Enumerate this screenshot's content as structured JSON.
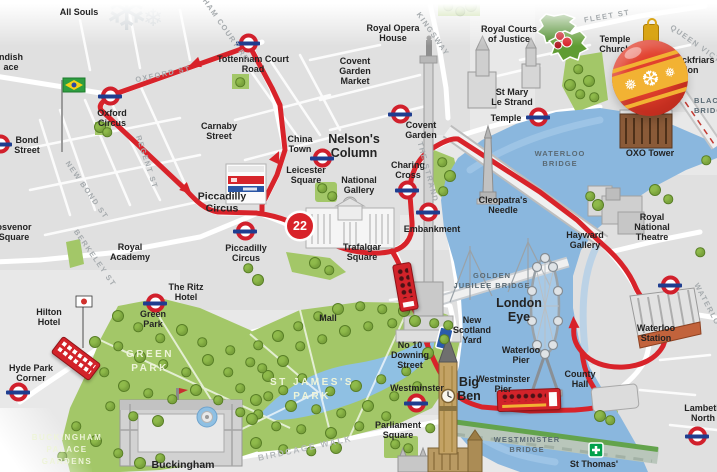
{
  "map": {
    "title": "London sightseeing bus tour map",
    "route_badge": "22",
    "colors": {
      "route_red": "#d8232a",
      "river_blue": "#8ab7de",
      "park_green": "#a3c768",
      "roundel_red": "#d1202c",
      "roundel_blue": "#1f3d8f",
      "bauble_red": "#e2402e",
      "bauble_gold": "#f2b233"
    },
    "decor": {
      "snowflake": "❄",
      "bauble_snowflakes": [
        "❅",
        "❆",
        "❅"
      ]
    },
    "labels": [
      {
        "id": "all-souls",
        "t": "All Souls",
        "x": 79,
        "y": 12,
        "cls": "lbl"
      },
      {
        "id": "cavendish-partial",
        "t": "ndish\nace",
        "x": 11,
        "y": 62,
        "cls": "lbl"
      },
      {
        "id": "bond-street",
        "t": "Bond\nStreet",
        "x": 27,
        "y": 145,
        "cls": "lbl"
      },
      {
        "id": "oxford-circus",
        "t": "Oxford\nCircus",
        "x": 112,
        "y": 118,
        "cls": "lbl"
      },
      {
        "id": "carnaby-street",
        "t": "Carnaby\nStreet",
        "x": 219,
        "y": 131,
        "cls": "lbl"
      },
      {
        "id": "tottenham-court-road",
        "t": "Tottenham Court\nRoad",
        "x": 253,
        "y": 64,
        "cls": "lbl"
      },
      {
        "id": "china-town",
        "t": "China\nTown",
        "x": 300,
        "y": 144,
        "cls": "lbl"
      },
      {
        "id": "leicester-square",
        "t": "Leicester\nSquare",
        "x": 306,
        "y": 175,
        "cls": "lbl"
      },
      {
        "id": "covent-garden-market",
        "t": "Covent\nGarden\nMarket",
        "x": 355,
        "y": 71,
        "cls": "lbl"
      },
      {
        "id": "royal-opera-house",
        "t": "Royal Opera\nHouse",
        "x": 393,
        "y": 33,
        "cls": "lbl"
      },
      {
        "id": "covent-garden",
        "t": "Covent\nGarden",
        "x": 421,
        "y": 130,
        "cls": "lbl"
      },
      {
        "id": "royal-courts",
        "t": "Royal Courts\nof Justice",
        "x": 509,
        "y": 34,
        "cls": "lbl"
      },
      {
        "id": "temple-church",
        "t": "Temple\nChurch",
        "x": 615,
        "y": 44,
        "cls": "lbl"
      },
      {
        "id": "st-mary-le-strand",
        "t": "St Mary\nLe Strand",
        "x": 512,
        "y": 97,
        "cls": "lbl"
      },
      {
        "id": "temple",
        "t": "Temple",
        "x": 506,
        "y": 118,
        "cls": "lbl"
      },
      {
        "id": "blackfriars-station",
        "t": "Blackfriars\nStation",
        "x": 668,
        "y": 55,
        "cls": "lbl noc"
      },
      {
        "id": "oxo-tower",
        "t": "OXO Tower",
        "x": 650,
        "y": 153,
        "cls": "lbl"
      },
      {
        "id": "nelsons-column",
        "t": "Nelson's\nColumn",
        "x": 354,
        "y": 146,
        "cls": "lbl big"
      },
      {
        "id": "national-gallery",
        "t": "National\nGallery",
        "x": 359,
        "y": 185,
        "cls": "lbl"
      },
      {
        "id": "charing-cross",
        "t": "Charing\nCross",
        "x": 408,
        "y": 170,
        "cls": "lbl"
      },
      {
        "id": "embankment",
        "t": "Embankment",
        "x": 432,
        "y": 229,
        "cls": "lbl"
      },
      {
        "id": "cleopatras-needle",
        "t": "Cleopatra's\nNeedle",
        "x": 503,
        "y": 205,
        "cls": "lbl"
      },
      {
        "id": "royal-national-theatre",
        "t": "Royal\nNational\nTheatre",
        "x": 652,
        "y": 227,
        "cls": "lbl"
      },
      {
        "id": "hayward-gallery",
        "t": "Hayward\nGallery",
        "x": 585,
        "y": 240,
        "cls": "lbl"
      },
      {
        "id": "waterloo-station",
        "t": "Waterloo\nStation",
        "x": 656,
        "y": 333,
        "cls": "lbl"
      },
      {
        "id": "county-hall",
        "t": "County\nHall",
        "x": 580,
        "y": 379,
        "cls": "lbl"
      },
      {
        "id": "waterloo-pier",
        "t": "Waterloo\nPier",
        "x": 521,
        "y": 355,
        "cls": "lbl"
      },
      {
        "id": "westminster-pier",
        "t": "Westminster\nPier",
        "x": 503,
        "y": 384,
        "cls": "lbl"
      },
      {
        "id": "london-eye",
        "t": "London\nEye",
        "x": 519,
        "y": 310,
        "cls": "lbl big"
      },
      {
        "id": "new-scotland-yard",
        "t": "New\nScotland\nYard",
        "x": 472,
        "y": 330,
        "cls": "lbl"
      },
      {
        "id": "no10-downing",
        "t": "No 10\nDowning\nStreet",
        "x": 410,
        "y": 355,
        "cls": "lbl"
      },
      {
        "id": "westminster",
        "t": "Westminster",
        "x": 417,
        "y": 388,
        "cls": "lbl"
      },
      {
        "id": "big-ben",
        "t": "Big\nBen",
        "x": 469,
        "y": 389,
        "cls": "lbl big"
      },
      {
        "id": "parliament-square",
        "t": "Parliament\nSquare",
        "x": 398,
        "y": 430,
        "cls": "lbl"
      },
      {
        "id": "st-thomas",
        "t": "St Thomas'",
        "x": 594,
        "y": 464,
        "cls": "lbl"
      },
      {
        "id": "lambeth-north",
        "t": "Lambeth\nNorth",
        "x": 703,
        "y": 413,
        "cls": "lbl"
      },
      {
        "id": "mall",
        "t": "Mall",
        "x": 328,
        "y": 318,
        "cls": "lbl"
      },
      {
        "id": "hilton-hotel",
        "t": "Hilton\nHotel",
        "x": 49,
        "y": 317,
        "cls": "lbl"
      },
      {
        "id": "ritz-hotel",
        "t": "The Ritz\nHotel",
        "x": 186,
        "y": 292,
        "cls": "lbl"
      },
      {
        "id": "royal-academy",
        "t": "Royal\nAcademy",
        "x": 130,
        "y": 252,
        "cls": "lbl"
      },
      {
        "id": "grosvenor-partial",
        "t": "osvenor\nSquare",
        "x": 14,
        "y": 232,
        "cls": "lbl"
      },
      {
        "id": "hyde-park-corner",
        "t": "Hyde Park\nCorner",
        "x": 31,
        "y": 373,
        "cls": "lbl"
      },
      {
        "id": "green-park-station",
        "t": "Green\nPark",
        "x": 153,
        "y": 319,
        "cls": "lbl"
      },
      {
        "id": "piccadilly-circus-main",
        "t": "Piccadilly\nCircus",
        "x": 222,
        "y": 203,
        "cls": "lbl med"
      },
      {
        "id": "piccadilly-circus-tube",
        "t": "Piccadilly\nCircus",
        "x": 246,
        "y": 253,
        "cls": "lbl"
      },
      {
        "id": "trafalgar-square",
        "t": "Trafalgar\nSquare",
        "x": 362,
        "y": 252,
        "cls": "lbl"
      },
      {
        "id": "buckingham",
        "t": "Buckingham",
        "x": 183,
        "y": 466,
        "cls": "lbl med"
      },
      {
        "id": "oxford-st",
        "t": "OXFORD ST",
        "x": 163,
        "y": 74,
        "cls": "street",
        "rot": -12
      },
      {
        "id": "regent-st",
        "t": "REGENT ST",
        "x": 147,
        "y": 162,
        "cls": "street",
        "rot": 72
      },
      {
        "id": "new-bond-st",
        "t": "NEW BOND ST",
        "x": 87,
        "y": 190,
        "cls": "street",
        "rot": 55
      },
      {
        "id": "berkeley-st",
        "t": "BERKELEY ST",
        "x": 95,
        "y": 258,
        "cls": "street",
        "rot": 55
      },
      {
        "id": "tottenham-ct-rd-street",
        "t": "TTENHAM COURT RD",
        "x": 219,
        "y": 20,
        "cls": "street",
        "rot": 55
      },
      {
        "id": "kingsway",
        "t": "KINGSWAY",
        "x": 433,
        "y": 34,
        "cls": "street",
        "rot": 55
      },
      {
        "id": "the-strand",
        "t": "THE STRAND",
        "x": 428,
        "y": 172,
        "cls": "street",
        "rot": 75
      },
      {
        "id": "fleet-st",
        "t": "FLEET ST",
        "x": 607,
        "y": 16,
        "cls": "street",
        "rot": -10
      },
      {
        "id": "queen-victoria-st",
        "t": "QUEEN VICTORIA ST",
        "x": 712,
        "y": 55,
        "cls": "street",
        "rot": 35
      },
      {
        "id": "waterloo-rd",
        "t": "WATERLOO RD",
        "x": 713,
        "y": 315,
        "cls": "street",
        "rot": 62
      },
      {
        "id": "birdcage-walk",
        "t": "BIRDCAGE WALK",
        "x": 305,
        "y": 448,
        "cls": "roadlbl",
        "rot": -12
      },
      {
        "id": "waterloo-bridge",
        "t": "WATERLOO\nBRIDGE",
        "x": 560,
        "y": 159,
        "cls": "bridge"
      },
      {
        "id": "golden-jubilee-bridge",
        "t": "GOLDEN\nJUBILEE BRIDGE",
        "x": 492,
        "y": 281,
        "cls": "bridge"
      },
      {
        "id": "westminster-bridge",
        "t": "WESTMINSTER\nBRIDGE",
        "x": 527,
        "y": 445,
        "cls": "bridge"
      },
      {
        "id": "blackfriars-bridge",
        "t": "BLACKFRIARS\nBRIDGE",
        "x": 694,
        "y": 96,
        "cls": "bridge noc"
      },
      {
        "id": "green-park",
        "t": "GREEN\nPARK",
        "x": 150,
        "y": 362,
        "cls": "park"
      },
      {
        "id": "st-jamess-park",
        "t": "ST JAMES'S\nPARK",
        "x": 312,
        "y": 390,
        "cls": "park"
      },
      {
        "id": "buckingham-palace-gardens",
        "t": "BUCKINGHAM\nPALACE\nGARDENS",
        "x": 67,
        "y": 450,
        "cls": "park parksm"
      }
    ],
    "stations": [
      {
        "id": "oxford-circus",
        "x": 110,
        "y": 96
      },
      {
        "id": "bond-street",
        "x": 0,
        "y": 144
      },
      {
        "id": "tottenham-court-road",
        "x": 248,
        "y": 43
      },
      {
        "id": "leicester-square",
        "x": 322,
        "y": 158
      },
      {
        "id": "covent-garden",
        "x": 400,
        "y": 114
      },
      {
        "id": "piccadilly-circus",
        "x": 245,
        "y": 231
      },
      {
        "id": "charing-cross",
        "x": 407,
        "y": 190
      },
      {
        "id": "embankment",
        "x": 428,
        "y": 212
      },
      {
        "id": "temple",
        "x": 538,
        "y": 117
      },
      {
        "id": "green-park",
        "x": 155,
        "y": 303
      },
      {
        "id": "hyde-park-corner",
        "x": 18,
        "y": 392
      },
      {
        "id": "westminster",
        "x": 416,
        "y": 403
      },
      {
        "id": "waterloo",
        "x": 670,
        "y": 285
      },
      {
        "id": "lambeth-north",
        "x": 697,
        "y": 436
      }
    ],
    "trees": [
      [
        118,
        316
      ],
      [
        138,
        327
      ],
      [
        160,
        338
      ],
      [
        182,
        330
      ],
      [
        202,
        342
      ],
      [
        118,
        346
      ],
      [
        140,
        357
      ],
      [
        163,
        364
      ],
      [
        186,
        372
      ],
      [
        208,
        360
      ],
      [
        228,
        372
      ],
      [
        104,
        372
      ],
      [
        124,
        386
      ],
      [
        148,
        393
      ],
      [
        172,
        399
      ],
      [
        196,
        390
      ],
      [
        218,
        400
      ],
      [
        240,
        388
      ],
      [
        256,
        400
      ],
      [
        110,
        406
      ],
      [
        133,
        416
      ],
      [
        158,
        421
      ],
      [
        240,
        412
      ],
      [
        258,
        414
      ],
      [
        95,
        342
      ],
      [
        230,
        350
      ],
      [
        250,
        362
      ],
      [
        268,
        376
      ],
      [
        283,
        390
      ],
      [
        76,
        426
      ],
      [
        96,
        441
      ],
      [
        118,
        453
      ],
      [
        62,
        456
      ],
      [
        140,
        463
      ],
      [
        160,
        458
      ],
      [
        258,
        345
      ],
      [
        278,
        336
      ],
      [
        298,
        326
      ],
      [
        318,
        316
      ],
      [
        338,
        309
      ],
      [
        360,
        306
      ],
      [
        382,
        309
      ],
      [
        404,
        311
      ],
      [
        300,
        346
      ],
      [
        322,
        339
      ],
      [
        345,
        331
      ],
      [
        368,
        326
      ],
      [
        392,
        323
      ],
      [
        415,
        321
      ],
      [
        434,
        323
      ],
      [
        262,
        368
      ],
      [
        283,
        361
      ],
      [
        302,
        378
      ],
      [
        330,
        391
      ],
      [
        356,
        386
      ],
      [
        381,
        379
      ],
      [
        406,
        371
      ],
      [
        428,
        353
      ],
      [
        444,
        339
      ],
      [
        268,
        396
      ],
      [
        291,
        406
      ],
      [
        316,
        409
      ],
      [
        341,
        413
      ],
      [
        368,
        406
      ],
      [
        394,
        396
      ],
      [
        417,
        386
      ],
      [
        252,
        419
      ],
      [
        276,
        426
      ],
      [
        301,
        429
      ],
      [
        331,
        433
      ],
      [
        359,
        426
      ],
      [
        386,
        416
      ],
      [
        256,
        443
      ],
      [
        283,
        449
      ],
      [
        311,
        451
      ],
      [
        336,
        448
      ],
      [
        448,
        325
      ],
      [
        442,
        162
      ],
      [
        450,
        176
      ],
      [
        443,
        191
      ],
      [
        578,
        69
      ],
      [
        589,
        81
      ],
      [
        580,
        94
      ],
      [
        594,
        97
      ],
      [
        570,
        85
      ],
      [
        448,
        6
      ],
      [
        460,
        11
      ],
      [
        471,
        6
      ],
      [
        660,
        80
      ],
      [
        670,
        93
      ],
      [
        662,
        104
      ],
      [
        322,
        188
      ],
      [
        332,
        196
      ],
      [
        100,
        127
      ],
      [
        107,
        132
      ],
      [
        240,
        82
      ],
      [
        655,
        190
      ],
      [
        668,
        199
      ],
      [
        590,
        196
      ],
      [
        598,
        205
      ],
      [
        706,
        160
      ],
      [
        700,
        252
      ],
      [
        315,
        263
      ],
      [
        329,
        270
      ],
      [
        248,
        268
      ],
      [
        258,
        280
      ],
      [
        395,
        444
      ],
      [
        408,
        448
      ],
      [
        600,
        416
      ],
      [
        610,
        420
      ],
      [
        430,
        428
      ]
    ]
  }
}
